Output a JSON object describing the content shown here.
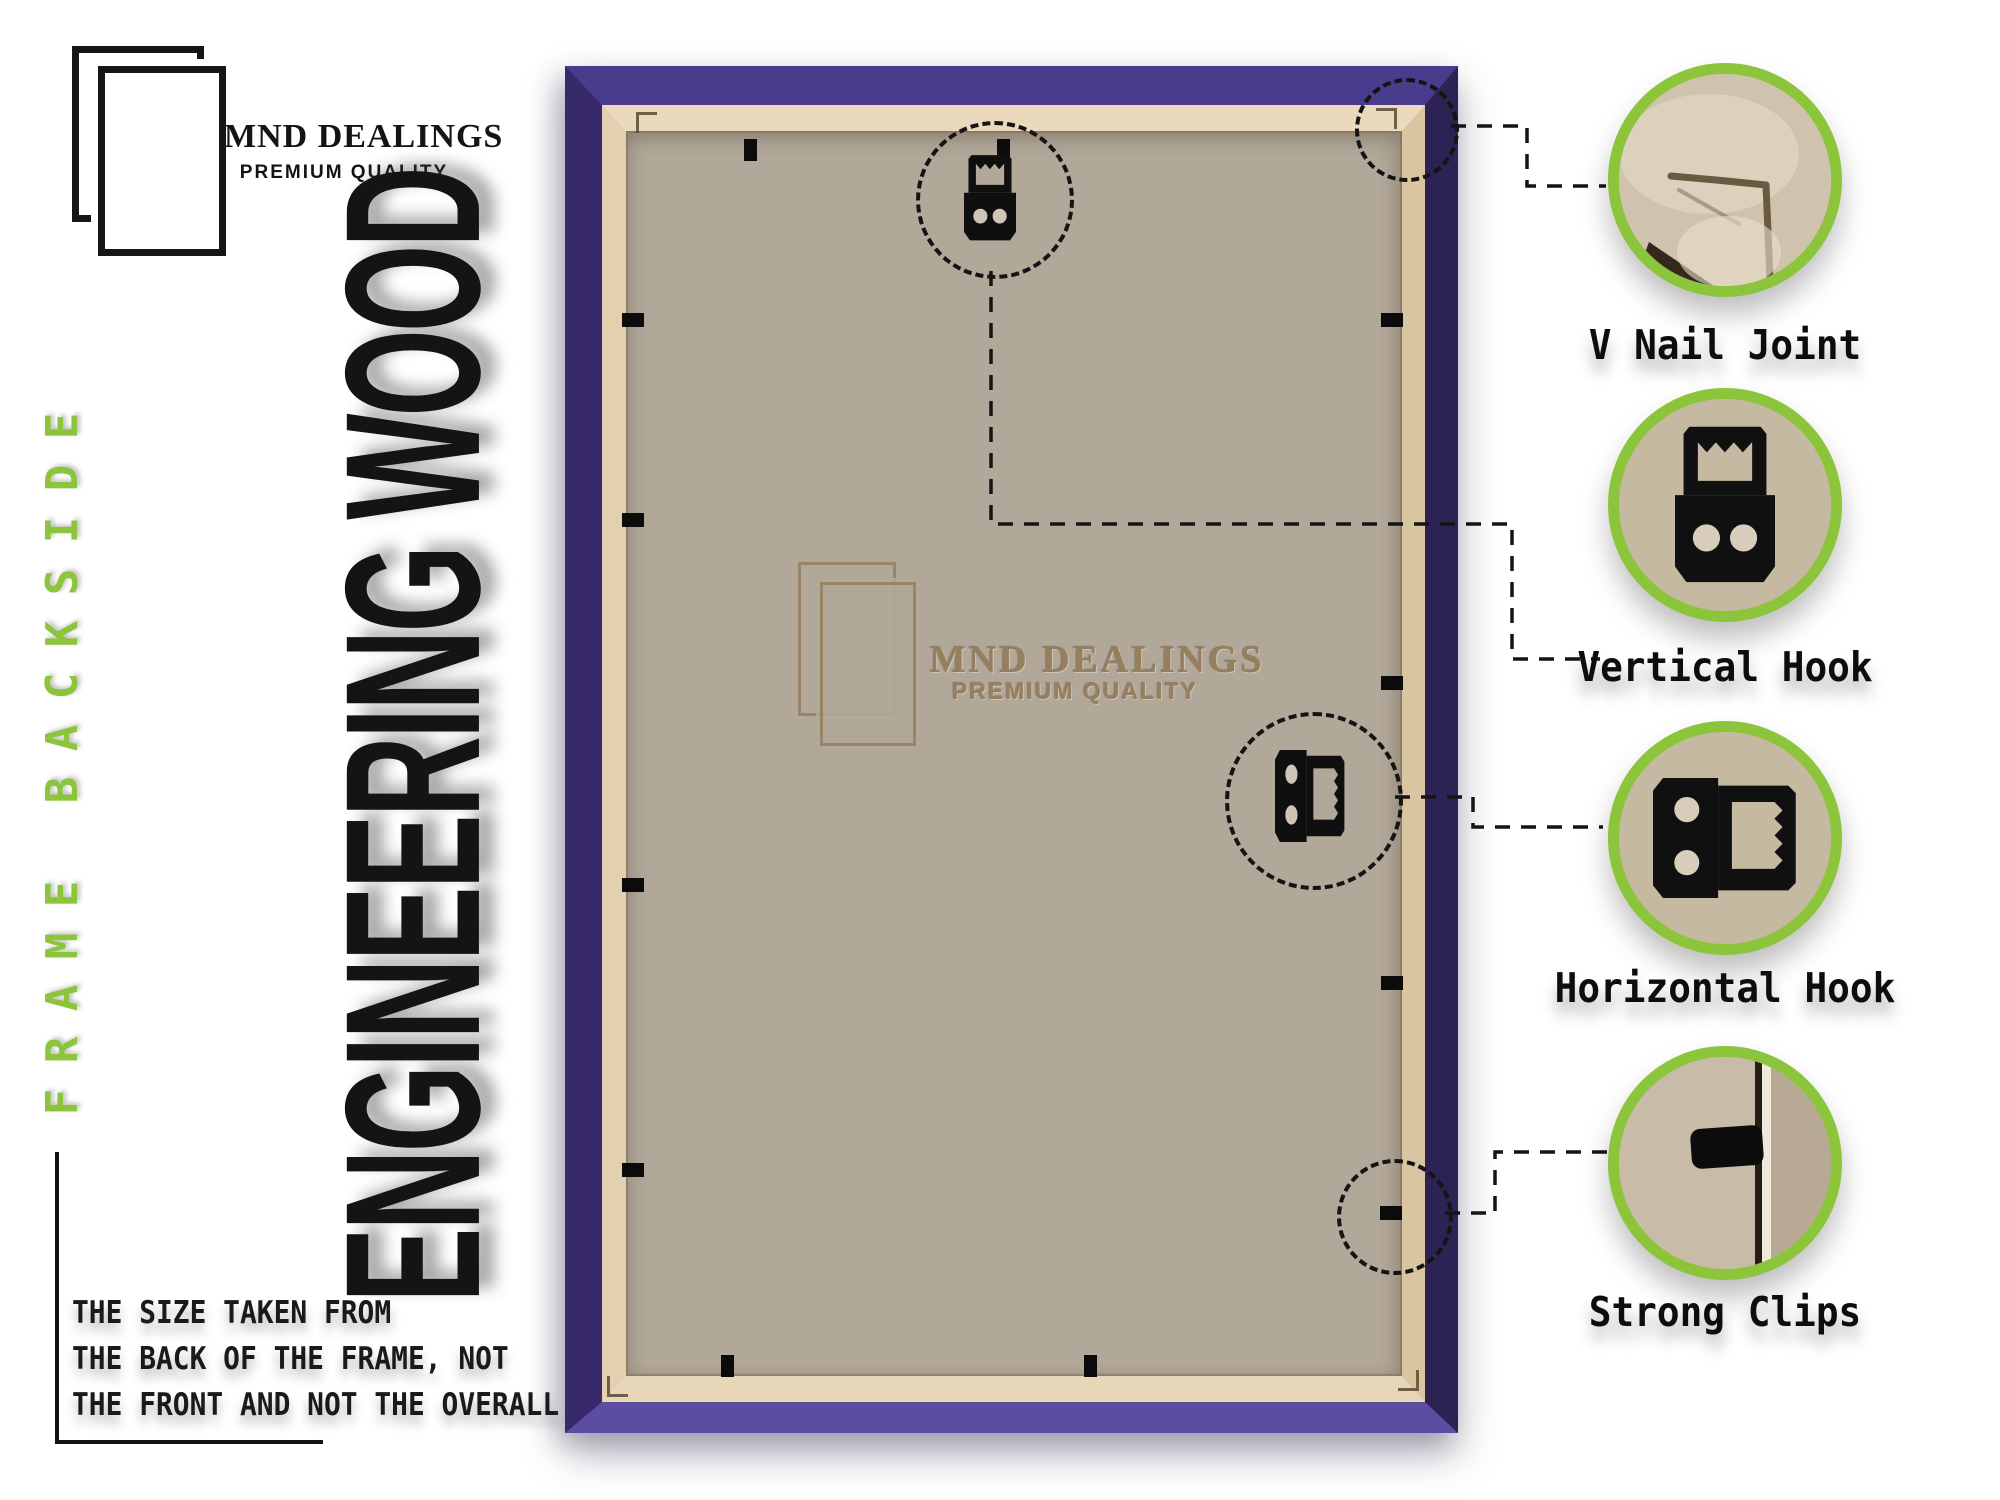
{
  "brand": {
    "name": "MND DEALINGS",
    "tagline": "PREMIUM QUALITY"
  },
  "side_label": {
    "text": "FRAME BACKSIDE",
    "color": "#8cc43c"
  },
  "title": "ENGINEERING WOOD",
  "note_lines": [
    "THE SIZE TAKEN FROM",
    "THE BACK OF THE FRAME, NOT",
    "THE FRONT AND NOT THE OVERALL SIZE."
  ],
  "watermark": {
    "name": "MND DEALINGS",
    "tagline": "PREMIUM QUALITY"
  },
  "callouts": [
    {
      "id": "v-nail-joint",
      "label": "V Nail Joint"
    },
    {
      "id": "vertical-hook",
      "label": "Vertical Hook"
    },
    {
      "id": "horizontal-hook",
      "label": "Horizontal Hook"
    },
    {
      "id": "strong-clips",
      "label": "Strong Clips"
    }
  ],
  "colors": {
    "accent_green": "#8cc43c",
    "frame_purple_top": "#4a3c8c",
    "frame_purple_right": "#2c2253",
    "frame_purple_bottom": "#5c4da0",
    "frame_purple_left": "#37296b",
    "lip_cream": "#e5d6b8",
    "board_mdf": "#b2a89a",
    "watermark_brown": "#957d5c"
  },
  "frame": {
    "clips": [
      {
        "x": 750,
        "y": 150,
        "o": "v"
      },
      {
        "x": 1003,
        "y": 150,
        "o": "v"
      },
      {
        "x": 633,
        "y": 320,
        "o": "h"
      },
      {
        "x": 633,
        "y": 520,
        "o": "h"
      },
      {
        "x": 633,
        "y": 885,
        "o": "h"
      },
      {
        "x": 633,
        "y": 1170,
        "o": "h"
      },
      {
        "x": 1392,
        "y": 320,
        "o": "h"
      },
      {
        "x": 1392,
        "y": 683,
        "o": "h"
      },
      {
        "x": 1392,
        "y": 983,
        "o": "h"
      },
      {
        "x": 1391,
        "y": 1213,
        "o": "h"
      },
      {
        "x": 727,
        "y": 1366,
        "o": "v"
      },
      {
        "x": 1090,
        "y": 1366,
        "o": "v"
      }
    ]
  }
}
